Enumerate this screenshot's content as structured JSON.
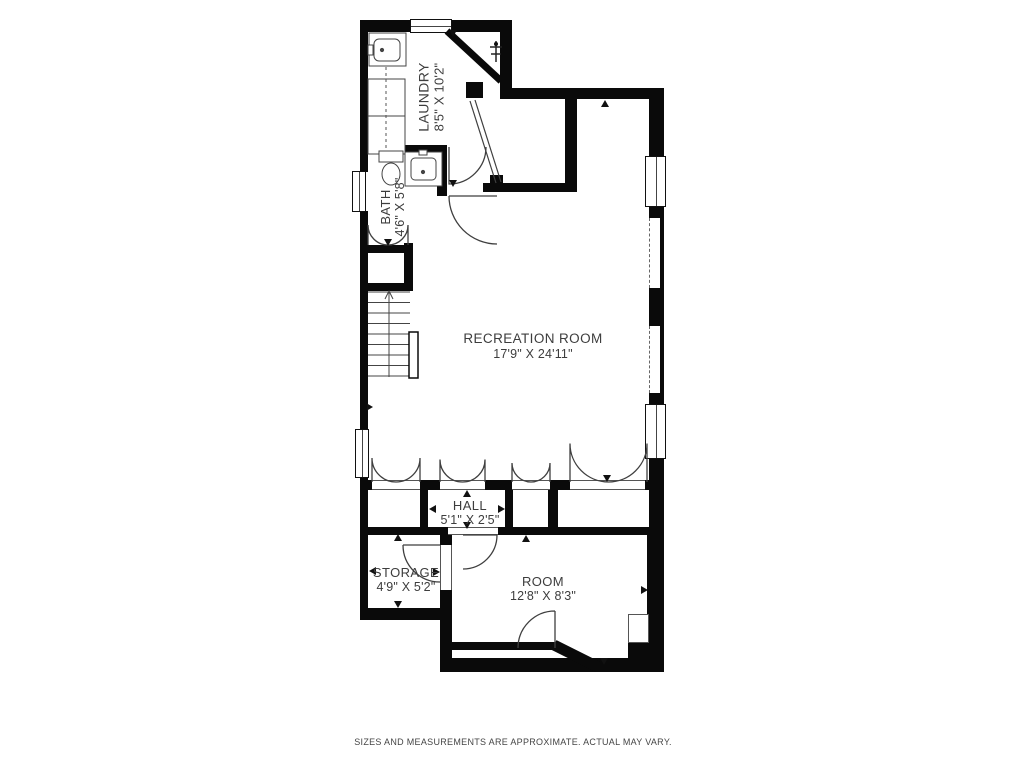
{
  "rooms": [
    {
      "name": "LAUNDRY",
      "dimensions": "8'5\" X 10'2\""
    },
    {
      "name": "BATH",
      "dimensions": "4'6\" X 5'8\""
    },
    {
      "name": "RECREATION ROOM",
      "dimensions": "17'9\" X 24'11\""
    },
    {
      "name": "HALL",
      "dimensions": "5'1\" X 2'5\""
    },
    {
      "name": "STORAGE",
      "dimensions": "4'9\" X 5'2\""
    },
    {
      "name": "ROOM",
      "dimensions": "12'8\" X 8'3\""
    }
  ],
  "disclaimer": "SIZES AND MEASUREMENTS ARE APPROXIMATE. ACTUAL MAY VARY.",
  "colors": {
    "background": "#ffffff",
    "walls": "#0a0a0a",
    "lines": "#3f3f3f",
    "text": "#3d3d3d"
  },
  "fixtures": [
    "laundry-sink-icon",
    "washer-icon",
    "dryer-icon",
    "valve-icon",
    "toilet-icon",
    "bath-sink-icon",
    "staircase",
    "stair-railing"
  ]
}
